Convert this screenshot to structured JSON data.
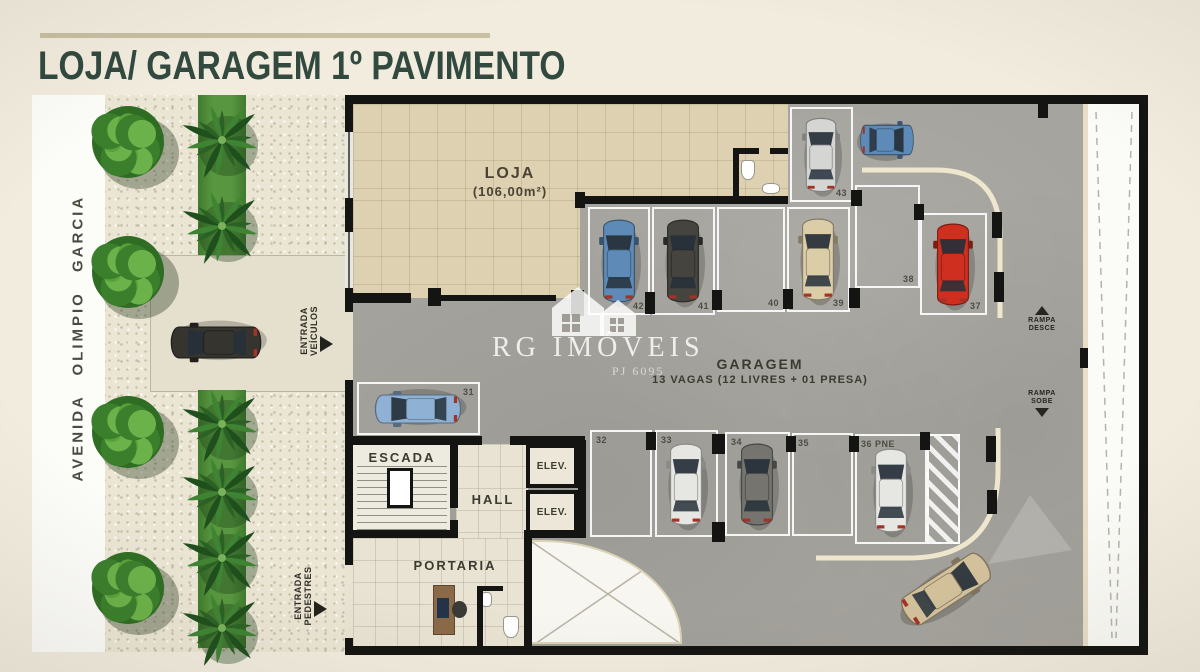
{
  "title": "LOJA/ GARAGEM 1º PAVIMENTO",
  "street": {
    "name": "AVENIDA OLIMPIO GARCIA"
  },
  "entrances": {
    "vehicles": {
      "line1": "ENTRADA",
      "line2": "VEÍCULOS"
    },
    "pedestrians": {
      "line1": "ENTRADA",
      "line2": "PEDESTRES"
    }
  },
  "labels": {
    "loja_name": "LOJA",
    "loja_area": "(106,00m²)",
    "garage_name": "GARAGEM",
    "garage_info": "13 VAGAS (12 LIVRES + 01 PRESA)",
    "escada": "ESCADA",
    "hall": "HALL",
    "elev": "ELEV.",
    "portaria": "PORTARIA",
    "ramp_down_line1": "RAMPA",
    "ramp_down_line2": "DESCE",
    "ramp_up_line1": "RAMPA",
    "ramp_up_line2": "SOBE"
  },
  "watermark": {
    "brand": "RG IMÓVEIS",
    "registry": "PJ 6095"
  },
  "parking": {
    "spots": [
      {
        "number": "31",
        "car": "lightblue"
      },
      {
        "number": "32",
        "car": null
      },
      {
        "number": "33",
        "car": "white"
      },
      {
        "number": "34",
        "car": "gray"
      },
      {
        "number": "35",
        "car": null
      },
      {
        "number": "36 PNE",
        "car": "white"
      },
      {
        "number": "37",
        "car": "red"
      },
      {
        "number": "38",
        "car": null
      },
      {
        "number": "39",
        "car": "cream"
      },
      {
        "number": "40",
        "car": null
      },
      {
        "number": "41",
        "car": "charcoal"
      },
      {
        "number": "42",
        "car": "steelblue"
      },
      {
        "number": "43",
        "car": "silver"
      }
    ]
  },
  "loose_cars": [
    {
      "id": "street-car",
      "color": "black"
    },
    {
      "id": "garage-top-car",
      "color": "steelblue"
    },
    {
      "id": "exit-car",
      "color": "tan"
    }
  ],
  "colors": {
    "title": "#31493f",
    "rule": "#c9c0a4",
    "background": "#f2ecdf",
    "wall": "#141412",
    "garage_floor": "#a6a49e",
    "loja_floor": "#ddd1b1",
    "sidewalk": "#ebe5d4",
    "curb": "#efe7cd",
    "green_strip": "#4e8c39",
    "car_palette": {
      "white": "#e6e6e3",
      "silver": "#d5d6d4",
      "gray": "#75746f",
      "charcoal": "#45443f",
      "red": "#cf2f1e",
      "cream": "#dbcda8",
      "black": "#35342f",
      "steelblue": "#5d8ab6",
      "lightblue": "#8fb2d4",
      "tan": "#d3c29c"
    }
  }
}
